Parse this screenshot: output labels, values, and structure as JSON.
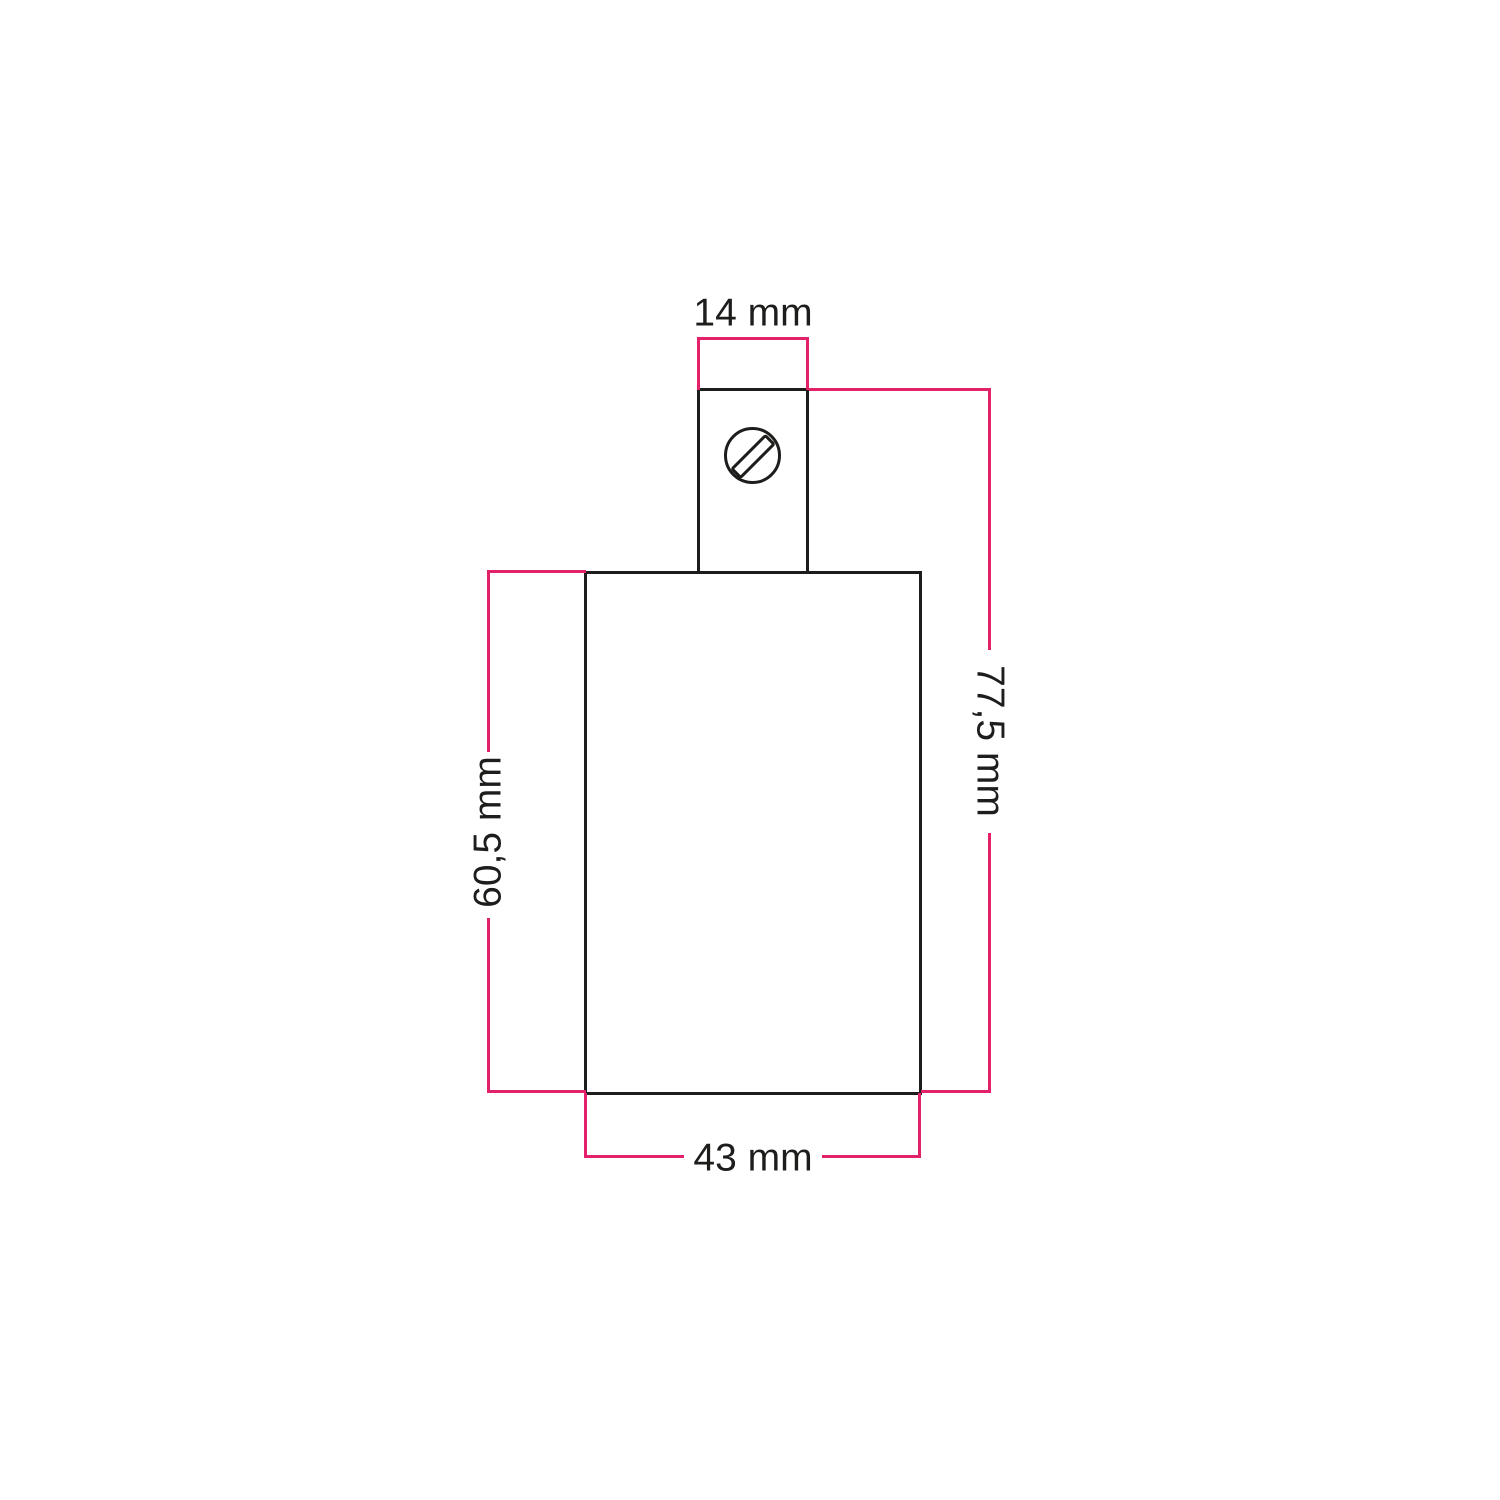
{
  "colors": {
    "accent": "#e2216a",
    "ink": "#1d1d1b",
    "background": "#ffffff"
  },
  "diagram": {
    "kind": "technical-dimension-drawing",
    "subject": "lamp holder with screw terminal cap",
    "icons": {
      "screw_head": "screw-head-icon"
    },
    "dimensions": {
      "cap_width": "14 mm",
      "overall_height": "77,5 mm",
      "body_height": "60,5 mm",
      "body_width": "43 mm"
    }
  }
}
